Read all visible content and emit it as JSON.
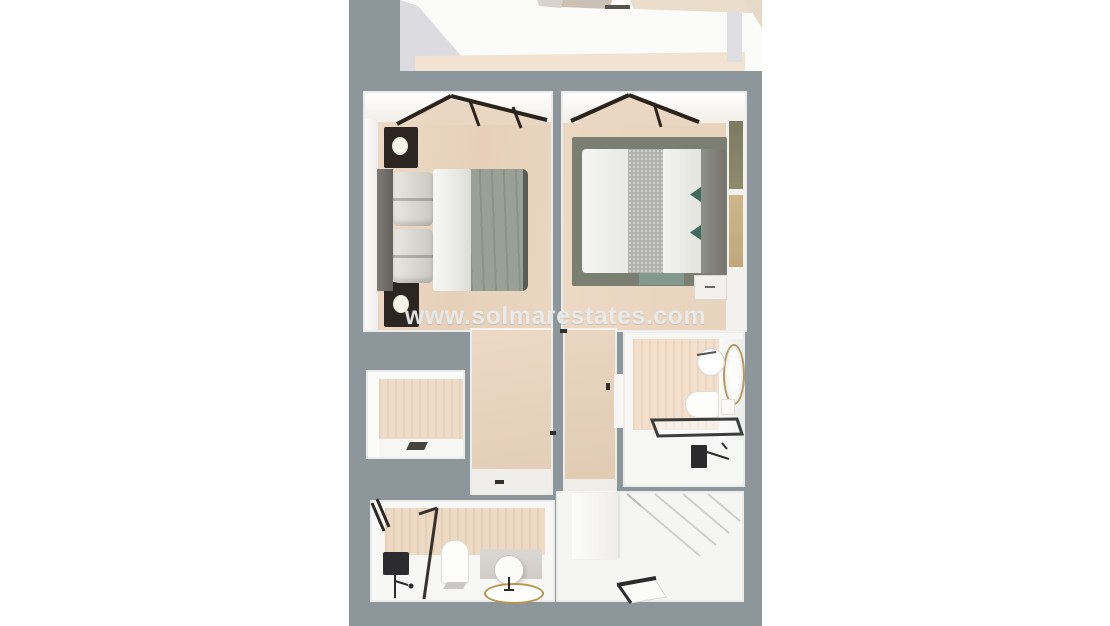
{
  "watermark": {
    "text": "www.solmarestates.com"
  },
  "palette": {
    "background": "#ffffff",
    "wall_gray": "#8d969b",
    "floor_wood": "#e8d3be",
    "wall_white": "#fafafa",
    "tile_beige": "#f0ddc9",
    "fixture_black": "#2c2c2e",
    "gold_trim": "#b3954f",
    "rug_green_gray": "#7b7f71",
    "furniture_dark_wood": "#2d2620",
    "accent_teal": "#3f6a60"
  },
  "scene": {
    "kind": "3D top-down floor plan render",
    "rooms": [
      {
        "name": "bedroom-left",
        "furniture": [
          "double-bed",
          "nightstand-with-lamp",
          "nightstand-with-lamp",
          "window-wall"
        ]
      },
      {
        "name": "bedroom-right",
        "furniture": [
          "double-bed",
          "area-rug",
          "nightstand",
          "wall-art",
          "window-wall"
        ]
      },
      {
        "name": "hallway-center",
        "furniture": []
      },
      {
        "name": "storage-closet",
        "furniture": [
          "floor-mat"
        ]
      },
      {
        "name": "corridor-right",
        "furniture": [
          "door"
        ]
      },
      {
        "name": "bathroom-upper",
        "furniture": [
          "round-sink",
          "oval-mirror",
          "toilet",
          "walk-in-shower",
          "black-shower-fixture"
        ]
      },
      {
        "name": "bathroom-lower",
        "furniture": [
          "glass-shower",
          "black-shower-panel",
          "toilet",
          "vanity-round-mirror",
          "oval-gold-sink",
          "window"
        ]
      },
      {
        "name": "stair-landing",
        "furniture": [
          "staircase",
          "floor-hatch"
        ]
      }
    ]
  }
}
